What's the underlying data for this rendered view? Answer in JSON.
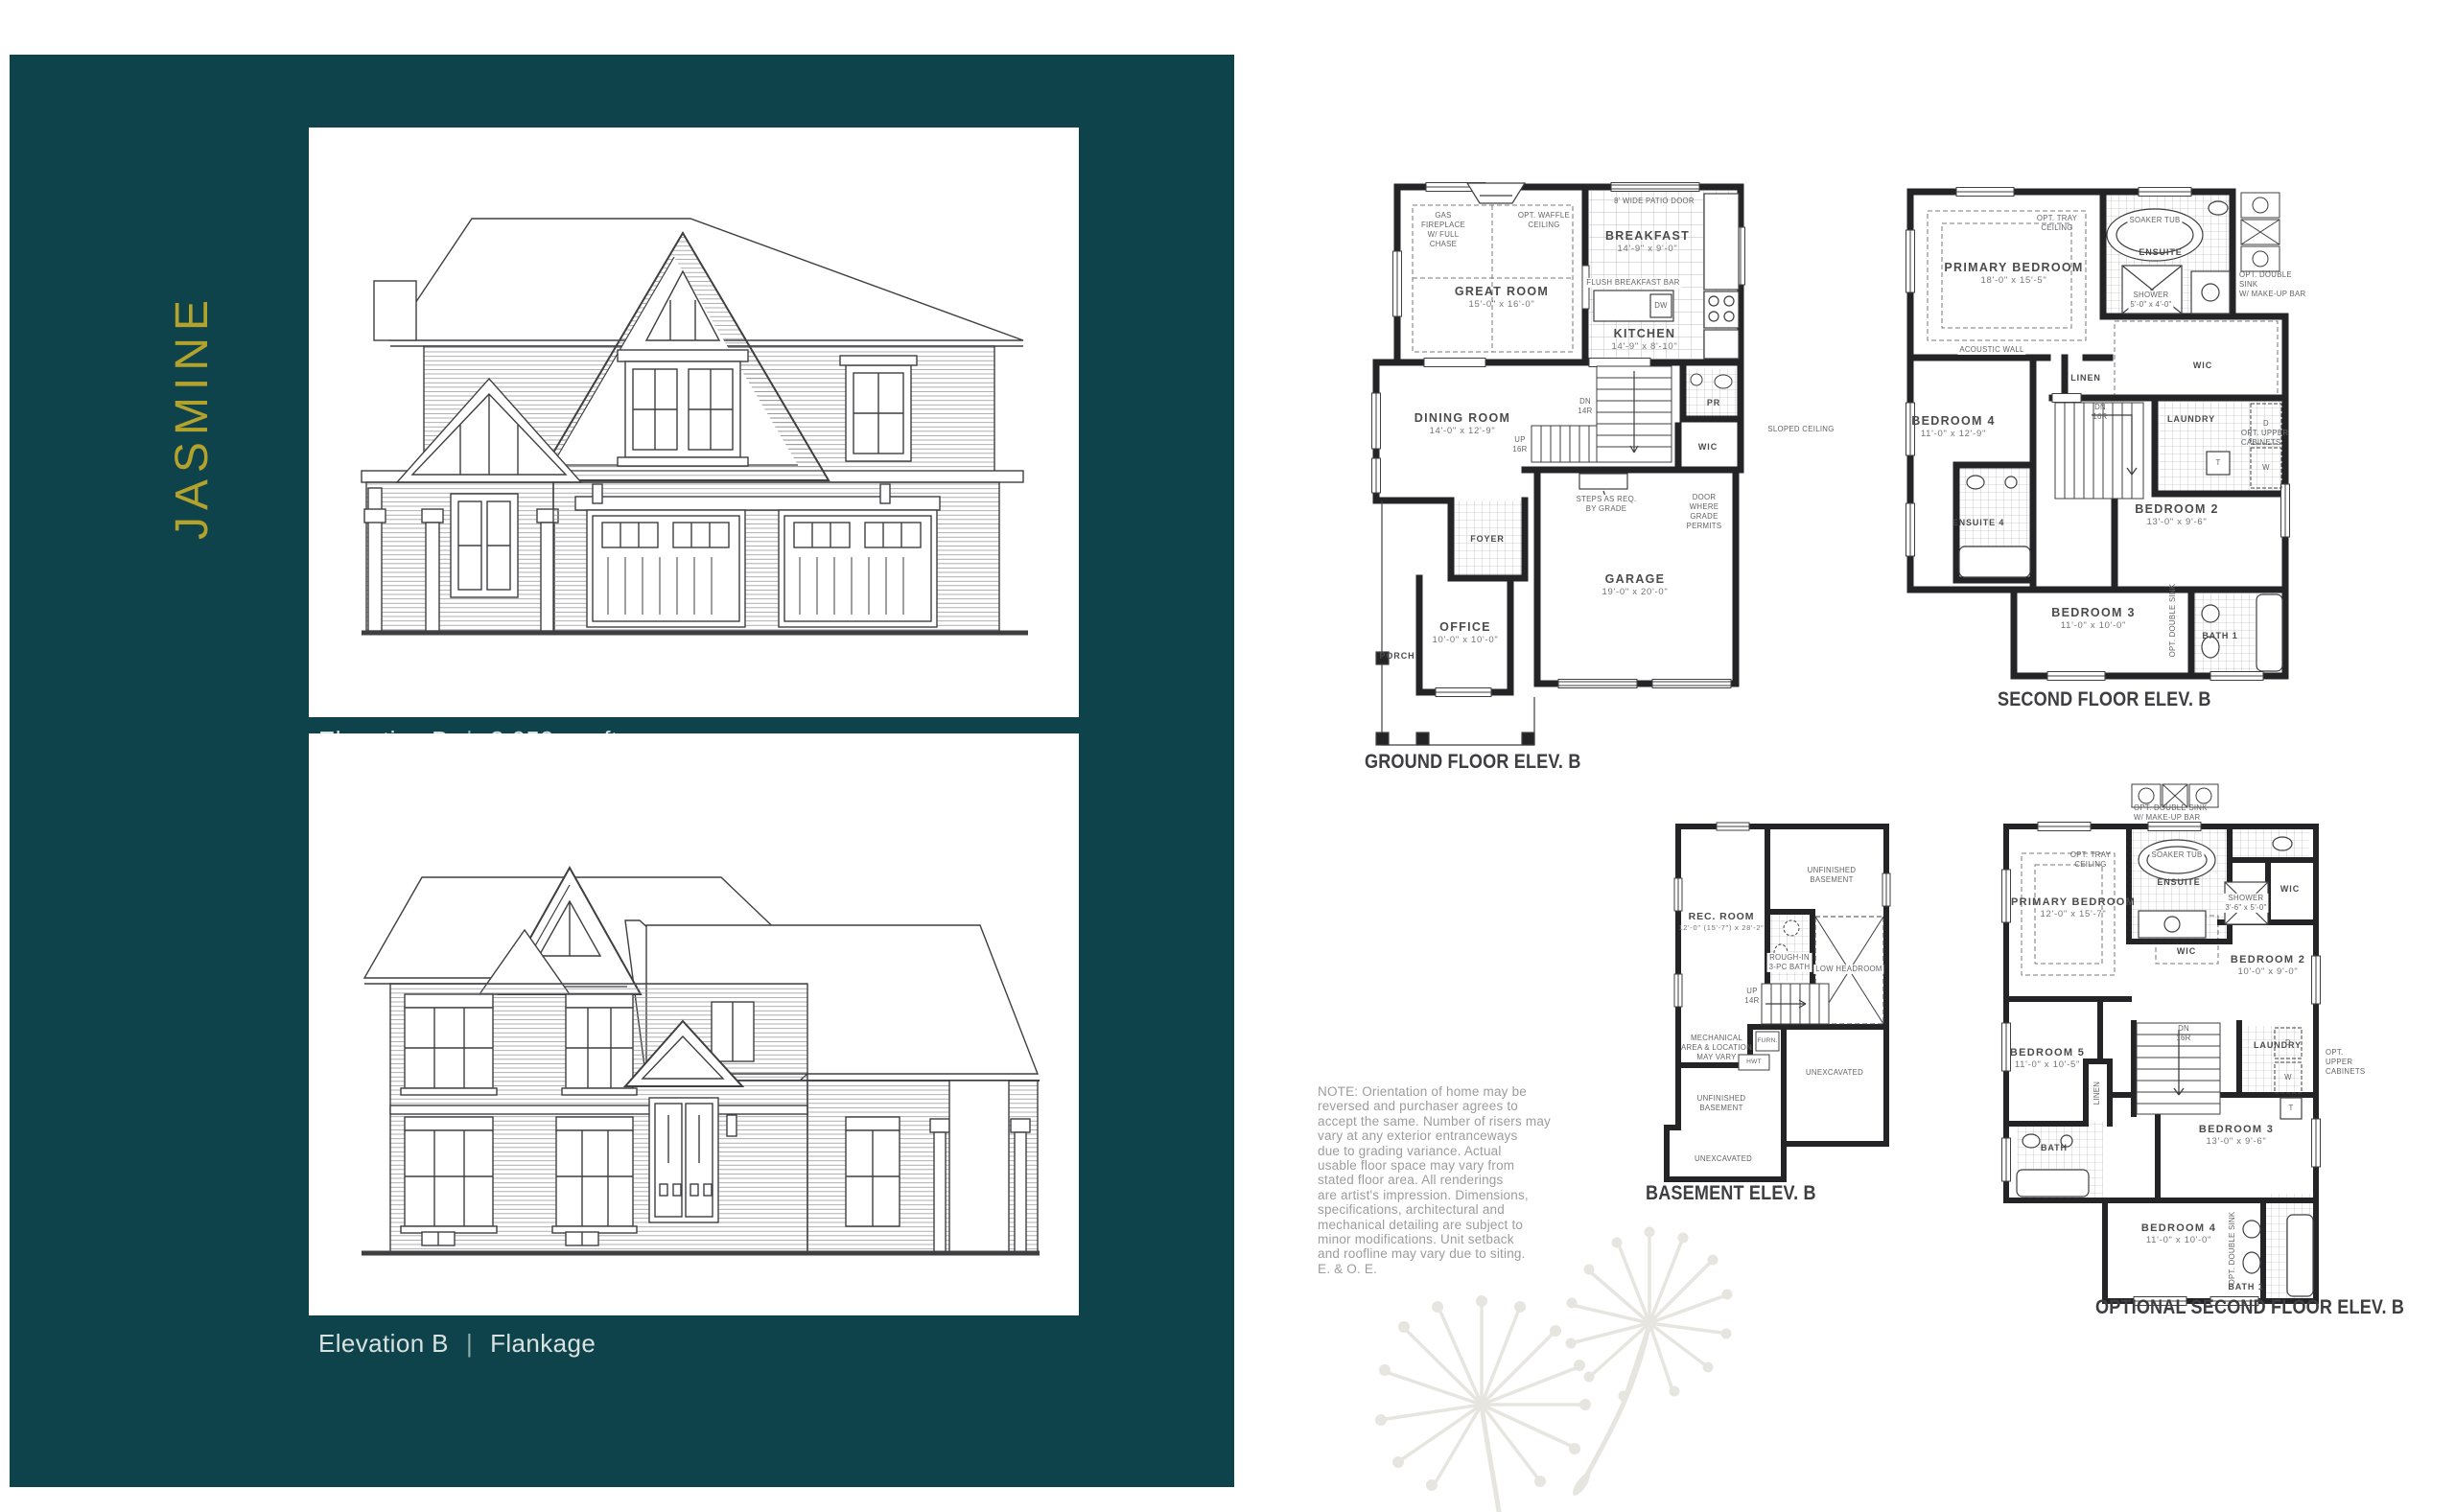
{
  "panel": {
    "title": "JASMINE",
    "captions": [
      {
        "name": "Elevation B",
        "separator": "|",
        "detail": "3,059 sq. ft."
      },
      {
        "name": "Elevation B",
        "separator": "|",
        "detail": "Flankage"
      }
    ]
  },
  "plans": {
    "ground": {
      "title": "GROUND FLOOR ELEV. B",
      "rooms": {
        "great": {
          "name": "GREAT ROOM",
          "dims": "15'-0\" x 16'-0\""
        },
        "breakfast": {
          "name": "BREAKFAST",
          "dims": "14'-9\" x 9'-0\""
        },
        "kitchen": {
          "name": "KITCHEN",
          "dims": "14'-9\" x 8'-10\""
        },
        "dining": {
          "name": "DINING ROOM",
          "dims": "14'-0\" x 12'-9\""
        },
        "garage": {
          "name": "GARAGE",
          "dims": "19'-0\" x 20'-0\""
        },
        "office": {
          "name": "OFFICE",
          "dims": "10'-0\" x 10'-0\""
        },
        "foyer": "FOYER",
        "porch": "PORCH",
        "wic": "WIC",
        "pr": "PR"
      },
      "annotations": {
        "fireplace": "GAS\nFIREPLACE\nW/ FULL\nCHASE",
        "waffle": "OPT. WAFFLE\nCEILING",
        "patio": "8' WIDE PATIO DOOR",
        "bar": "FLUSH BREAKFAST BAR",
        "dw": "DW",
        "dn": "DN\n14R",
        "up": "UP\n16R",
        "steps": "STEPS AS REQ.\nBY GRADE",
        "door": "DOOR\nWHERE\nGRADE\nPERMITS"
      }
    },
    "second": {
      "title": "SECOND FLOOR ELEV. B",
      "rooms": {
        "primary": {
          "name": "PRIMARY BEDROOM",
          "dims": "18'-0\" x 15'-5\""
        },
        "bedroom4": {
          "name": "BEDROOM 4",
          "dims": "11'-0\" x 12'-9\""
        },
        "bedroom2": {
          "name": "BEDROOM 2",
          "dims": "13'-0\" x 9'-6\""
        },
        "bedroom3": {
          "name": "BEDROOM 3",
          "dims": "11'-0\" x 10'-0\""
        },
        "ensuite": "ENSUITE",
        "ensuite4": "ENSUITE 4",
        "bath1": "BATH 1",
        "wic": "WIC",
        "linen": "LINEN",
        "laundry": "LAUNDRY"
      },
      "annotations": {
        "soaker": "SOAKER TUB",
        "tray": "OPT. TRAY\nCEILING",
        "shower_name": "SHOWER",
        "shower_dims": "5'-0\" x 4'-0\"",
        "double_sink": "OPT. DOUBLE SINK\nW/ MAKE-UP BAR",
        "acoustic": "ACOUSTIC WALL",
        "sloped": "SLOPED CEILING",
        "dn": "DN\n16R",
        "upper_cabinets": "OPT. UPPER\nCABINETS",
        "double_sink_vert": "OPT. DOUBLE SINK",
        "d": "D",
        "w": "W",
        "t": "T"
      }
    },
    "basement": {
      "title": "BASEMENT ELEV. B",
      "rooms": {
        "rec": {
          "name": "REC. ROOM",
          "dims": "12'-0\" (15'-7\") x 28'-2\""
        },
        "unfinished_upper": "UNFINISHED\nBASEMENT",
        "unfinished_lower": "UNFINISHED\nBASEMENT",
        "unexcavated_right": "UNEXCAVATED",
        "unexcavated_lower": "UNEXCAVATED"
      },
      "annotations": {
        "rough_in": "ROUGH-IN\n3-PC BATH",
        "low_headroom": "LOW HEADROOM",
        "mechanical": "MECHANICAL\nAREA & LOCATION\nMAY VARY",
        "furnace": "FURN.",
        "hwt": "HWT",
        "up": "UP\n14R"
      }
    },
    "optional": {
      "title": "OPTIONAL SECOND FLOOR ELEV. B",
      "rooms": {
        "primary": {
          "name": "PRIMARY BEDROOM",
          "dims": "12'-0\" x 15'-7\""
        },
        "bedroom2": {
          "name": "BEDROOM 2",
          "dims": "10'-0\" x 9'-0\""
        },
        "bedroom5": {
          "name": "BEDROOM 5",
          "dims": "11'-0\" x 10'-5\""
        },
        "bedroom3": {
          "name": "BEDROOM 3",
          "dims": "13'-0\" x 9'-6\""
        },
        "bedroom4": {
          "name": "BEDROOM 4",
          "dims": "11'-0\" x 10'-0\""
        },
        "ensuite": "ENSUITE",
        "bath": "BATH",
        "bath1": "BATH 1",
        "wic_right": "WIC",
        "wic_center": "WIC",
        "linen": "LINEN",
        "laundry": "LAUNDRY"
      },
      "annotations": {
        "soaker": "SOAKER TUB",
        "tray": "OPT. TRAY\nCEILING",
        "shower_name": "SHOWER",
        "shower_dims": "3'-6\" x 5'-0\"",
        "double_sink": "OPT. DOUBLE SINK\nW/ MAKE-UP BAR",
        "dn": "DN\n16R",
        "upper_cabinets": "OPT. UPPER\nCABINETS",
        "double_sink_vert": "OPT. DOUBLE SINK",
        "d": "D",
        "w": "W",
        "t": "T"
      }
    }
  },
  "note": {
    "lines": [
      "NOTE: Orientation of home may be",
      "reversed and purchaser agrees to",
      "accept the same. Number of risers may",
      "vary at any exterior entranceways",
      "due to grading variance. Actual",
      "usable floor space may vary from",
      "stated floor area. All renderings",
      "are artist's impression. Dimensions,",
      "specifications, architectural and",
      "mechanical detailing are subject to",
      "minor modifications. Unit setback",
      "and roofline may vary due to siting.",
      "E. & O. E."
    ]
  }
}
